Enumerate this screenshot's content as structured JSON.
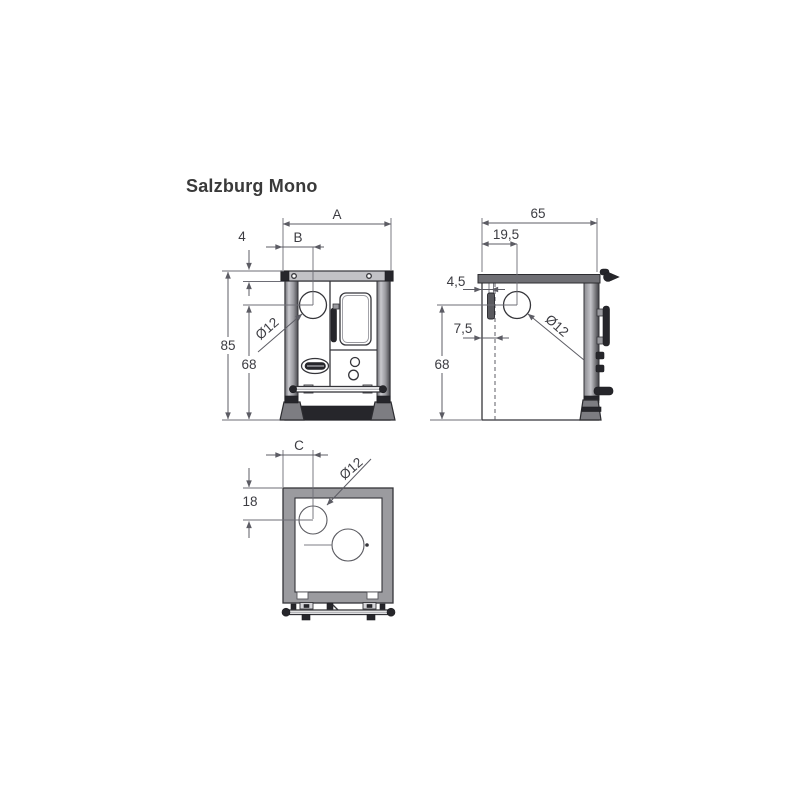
{
  "title": "Salzburg Mono",
  "views": {
    "front": {
      "dim_width": "A",
      "dim_flue_x": "B",
      "dim_plate_thickness": "4",
      "dim_height_total": "85",
      "dim_height_flue": "68",
      "dim_flue_diameter": "Ø12"
    },
    "side": {
      "dim_depth": "65",
      "dim_flue_from_back": "19,5",
      "dim_back_offset": "4,5",
      "dim_wall_offset": "7,5",
      "dim_height_flue": "68",
      "dim_flue_diameter": "Ø12"
    },
    "top": {
      "dim_flue_x": "C",
      "dim_flue_from_back": "18",
      "dim_flue_diameter": "Ø12"
    }
  },
  "colors": {
    "object_line": "#35353a",
    "dimension_line": "#5c5c64",
    "text": "#3c3c42",
    "plate_light_gray": "#c2c2c6",
    "plate_mid_gray": "#6f6f74",
    "top_frame_gray": "#9b9b9f",
    "dark_fill": "#26262b",
    "title_color": "#3a3a3a",
    "background": "#ffffff"
  }
}
